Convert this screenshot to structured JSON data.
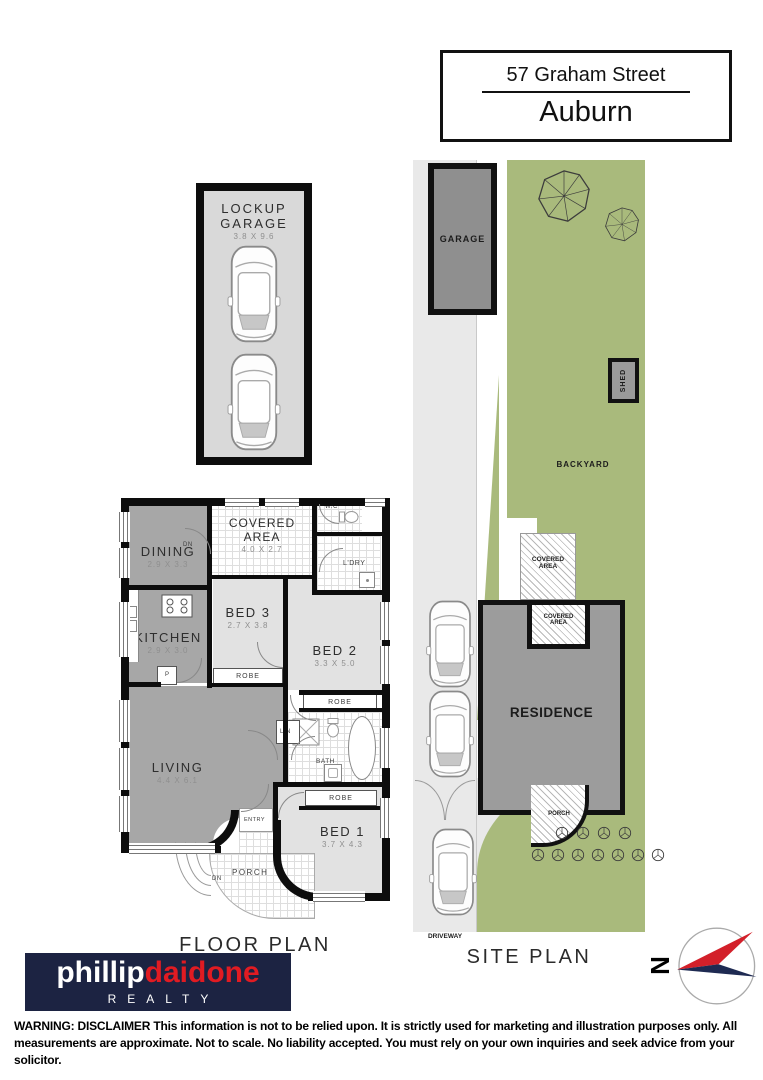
{
  "address": {
    "street": "57 Graham Street",
    "suburb": "Auburn"
  },
  "lockup_garage": {
    "title": "LOCKUP GARAGE",
    "dims": "3.8 X 9.6"
  },
  "floor_plan": {
    "caption": "FLOOR PLAN",
    "dining": {
      "name": "DINING",
      "dims": "2.9 X 3.3"
    },
    "covered_area": {
      "name": "COVERED AREA",
      "dims": "4.0 X 2.7"
    },
    "wc": "W.C",
    "laundry": "L'DRY",
    "kitchen": {
      "name": "KITCHEN",
      "dims": "2.9 X 3.0"
    },
    "bed3": {
      "name": "BED 3",
      "dims": "2.7 X 3.8"
    },
    "bed2": {
      "name": "BED 2",
      "dims": "3.3 X 5.0"
    },
    "bed1": {
      "name": "BED 1",
      "dims": "3.7 X 4.3"
    },
    "living": {
      "name": "LIVING",
      "dims": "4.4 X 6.1"
    },
    "bath": "BATH",
    "porch": "PORCH",
    "entry": "ENTRY",
    "robe": "ROBE",
    "linen": "LIN",
    "pantry": "P",
    "down": "DN"
  },
  "site_plan": {
    "caption": "SITE PLAN",
    "garage": "GARAGE",
    "shed": "SHED",
    "backyard": "BACKYARD",
    "covered_area": "COVERED AREA",
    "residence": "RESIDENCE",
    "porch": "PORCH",
    "driveway": "DRIVEWAY"
  },
  "compass": {
    "north": "N"
  },
  "brand": {
    "first": "phillip",
    "last": "daidone",
    "tagline": "REALTY"
  },
  "disclaimer": "WARNING: DISCLAIMER This information is not to be relied upon. It is strictly used for marketing and illustration purposes only. All measurements are approximate. Not to scale. No liability accepted. You must rely on your own inquiries and seek advice from your solicitor.",
  "colors": {
    "site_green": "#a9ba7c",
    "plan_gray": "#a7a7a7",
    "bedroom_gray": "#e2e2e2",
    "residence_gray": "#9c9c9c",
    "wall_black": "#0d0d0d",
    "brand_navy": "#1c2342",
    "brand_red": "#e11b22",
    "compass_red": "#d3202a",
    "compass_navy": "#1e2a52"
  }
}
